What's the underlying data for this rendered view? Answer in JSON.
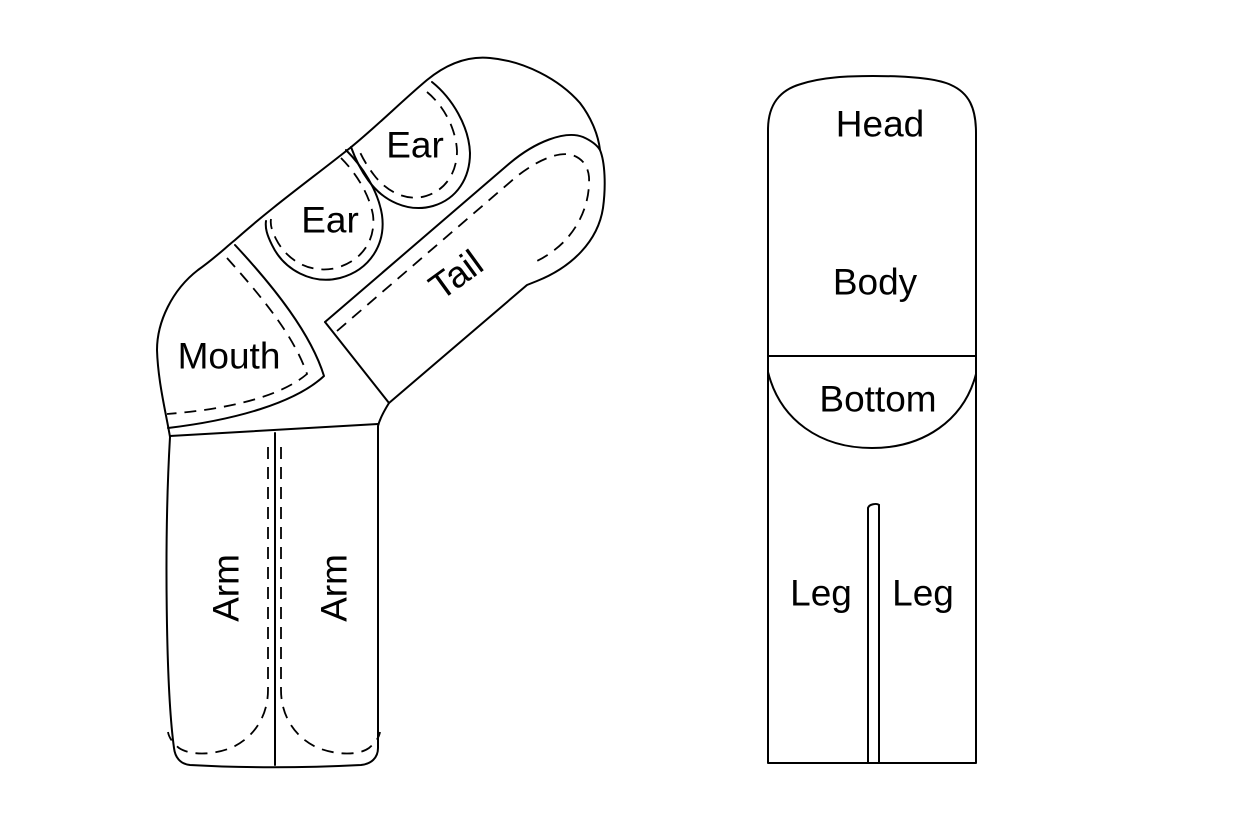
{
  "canvas": {
    "width": 1255,
    "height": 828,
    "background": "#ffffff",
    "line_color": "#000000",
    "text_color": "#000000"
  },
  "left_pattern": {
    "labels": [
      {
        "id": "ear-top",
        "text": "Ear"
      },
      {
        "id": "ear-bottom",
        "text": "Ear"
      },
      {
        "id": "tail",
        "text": "Tail"
      },
      {
        "id": "mouth",
        "text": "Mouth"
      },
      {
        "id": "arm-left",
        "text": "Arm"
      },
      {
        "id": "arm-right",
        "text": "Arm"
      }
    ]
  },
  "right_pattern": {
    "labels": [
      {
        "id": "head",
        "text": "Head"
      },
      {
        "id": "body",
        "text": "Body"
      },
      {
        "id": "bottom",
        "text": "Bottom"
      },
      {
        "id": "leg-left",
        "text": "Leg"
      },
      {
        "id": "leg-right",
        "text": "Leg"
      }
    ]
  }
}
